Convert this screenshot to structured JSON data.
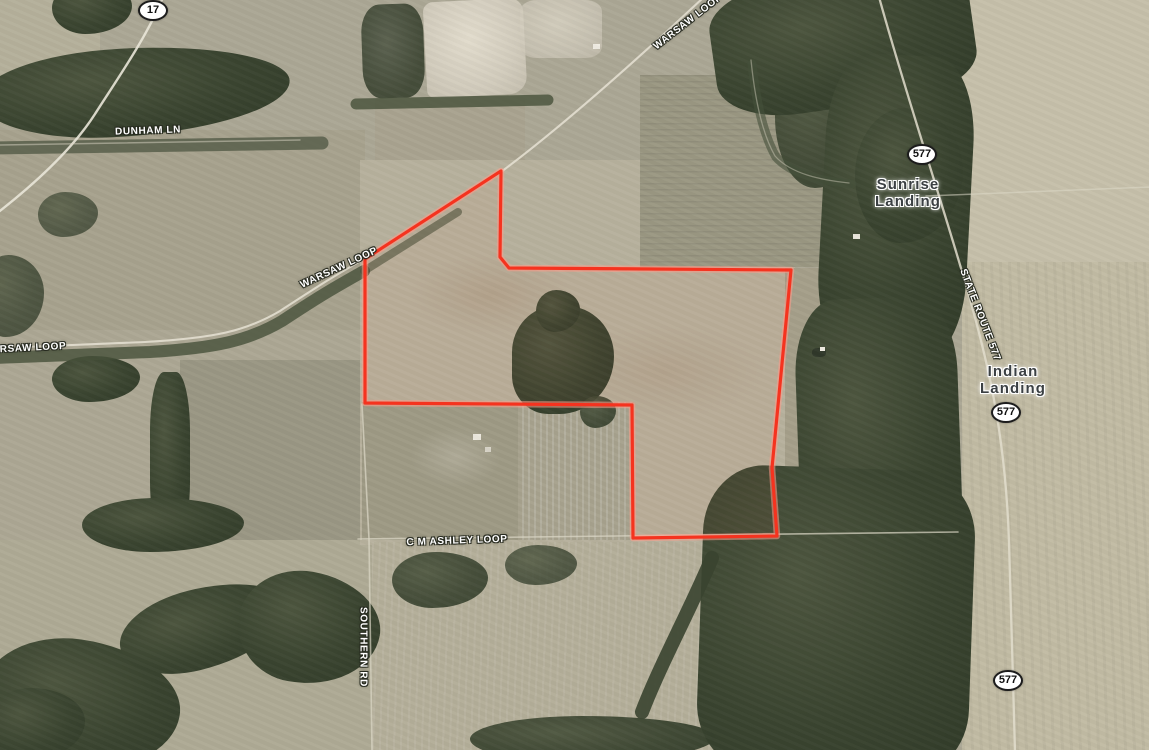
{
  "map": {
    "type": "satellite-parcel-map",
    "parcel": {
      "stroke_color": "#f5331f",
      "halo_color": "#ff9d8a",
      "points": [
        [
          501,
          171
        ],
        [
          365,
          259
        ],
        [
          365,
          403
        ],
        [
          632,
          405
        ],
        [
          633,
          538
        ],
        [
          777,
          536
        ],
        [
          772,
          468
        ],
        [
          791,
          270
        ],
        [
          509,
          268
        ],
        [
          500,
          257
        ]
      ]
    },
    "labels": [
      {
        "id": "dunham-ln",
        "text": "DUNHAM LN",
        "x": 148,
        "y": 131,
        "rot": -2,
        "kind": "road"
      },
      {
        "id": "warsaw-loop-top",
        "text": "WARSAW LOOP",
        "x": 688,
        "y": 22,
        "rot": -38,
        "kind": "road"
      },
      {
        "id": "warsaw-loop-mid",
        "text": "WARSAW LOOP",
        "x": 339,
        "y": 268,
        "rot": -25,
        "kind": "road"
      },
      {
        "id": "warsaw-loop-left",
        "text": "RSAW LOOP",
        "x": 33,
        "y": 348,
        "rot": -3,
        "kind": "road"
      },
      {
        "id": "cm-ashley-loop",
        "text": "C M ASHLEY LOOP",
        "x": 457,
        "y": 541,
        "rot": -2,
        "kind": "road"
      },
      {
        "id": "southern-rd",
        "text": "SOUTHERN RD",
        "x": 363,
        "y": 647,
        "rot": 90,
        "kind": "road"
      },
      {
        "id": "state-route-577",
        "text": "STATE ROUTE 577",
        "x": 980,
        "y": 315,
        "rot": 69,
        "kind": "road"
      },
      {
        "id": "sunrise-landing",
        "text": "Sunrise\nLanding",
        "x": 908,
        "y": 193,
        "rot": 0,
        "kind": "place"
      },
      {
        "id": "indian-landing",
        "text": "Indian\nLanding",
        "x": 1013,
        "y": 380,
        "rot": 0,
        "kind": "place"
      }
    ],
    "shields": [
      {
        "id": "route-17",
        "text": "17",
        "x": 153,
        "y": 10
      },
      {
        "id": "route-577-north",
        "text": "577",
        "x": 922,
        "y": 154
      },
      {
        "id": "route-577-mid",
        "text": "577",
        "x": 1006,
        "y": 412
      },
      {
        "id": "route-577-south",
        "text": "577",
        "x": 1008,
        "y": 680
      }
    ],
    "roads": [
      {
        "id": "route-17",
        "d": "M 163,-3 C 148,35 118,78 95,114 C 72,150 32,186 -4,214",
        "width": 2.4,
        "color": "#e9e5d8",
        "opacity": 0.9
      },
      {
        "id": "dunham-ln",
        "d": "M 0,145 L 300,140",
        "width": 1.4,
        "color": "#d9d4c4",
        "opacity": 0.5
      },
      {
        "id": "warsaw-loop",
        "d": "M 0,348 L 145,342 C 215,338 246,331 280,311 C 320,285 332,277 366,258 L 501,172 C 560,128 628,68 704,-3",
        "width": 2.1,
        "color": "#e6e2d4",
        "opacity": 0.85
      },
      {
        "id": "cm-ashley-loop",
        "d": "M 358,539 L 958,532",
        "width": 1.6,
        "color": "#ddd8c8",
        "opacity": 0.7
      },
      {
        "id": "southern-rd",
        "d": "M 362,404 L 369,539 L 372,752",
        "width": 1.6,
        "color": "#ddd8c8",
        "opacity": 0.7
      },
      {
        "id": "state-route-577",
        "d": "M 879,-3 C 897,62 917,125 935,183 C 954,245 975,310 989,375 C 1000,425 1007,482 1009,542 C 1011,602 1013,682 1015,752",
        "width": 2.3,
        "color": "#e2ddcd",
        "opacity": 0.85
      },
      {
        "id": "sunrise-access-rd",
        "d": "M 926,196 L 1151,187",
        "width": 1.5,
        "color": "#ddd8c8",
        "opacity": 0.55
      },
      {
        "id": "farm-track",
        "d": "M 751,60 C 755,100 763,135 775,156 C 791,174 821,180 849,183",
        "width": 1.3,
        "color": "#d5d0bf",
        "opacity": 0.45
      }
    ]
  }
}
